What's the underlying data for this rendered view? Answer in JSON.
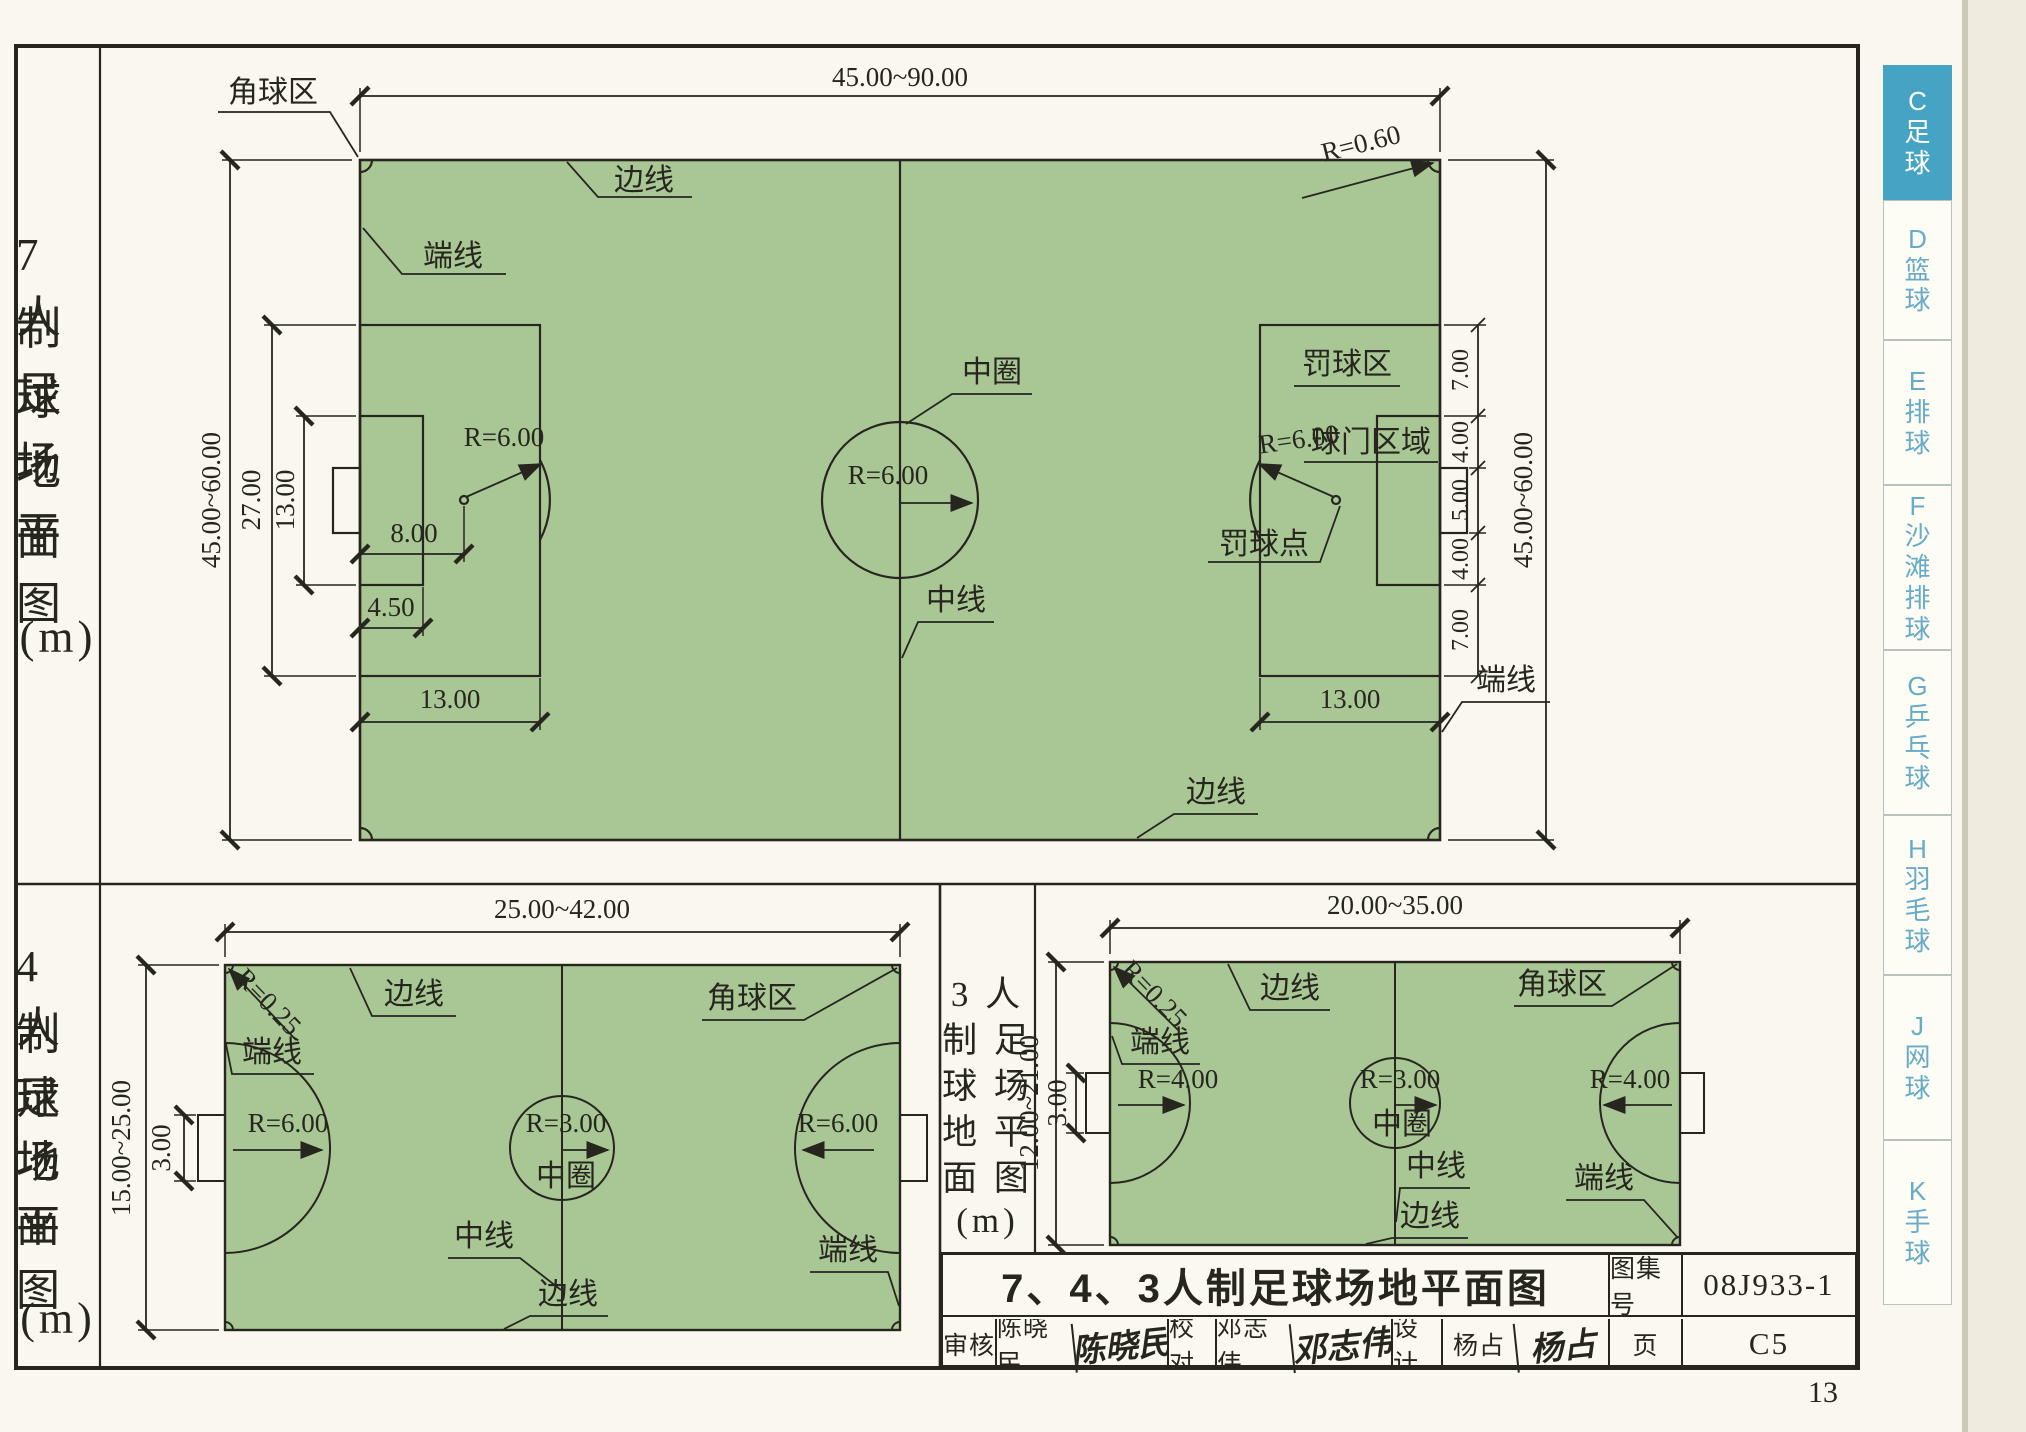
{
  "page": {
    "number": "13"
  },
  "colors": {
    "field_green": "#a9c795",
    "line": "#26261f",
    "tab_active_bg": "#45a3c4",
    "tab_text": "#66abc8"
  },
  "sidebar": {
    "tabs": [
      {
        "letter": "C",
        "name": "足球",
        "active": true
      },
      {
        "letter": "D",
        "name": "篮球",
        "active": false
      },
      {
        "letter": "E",
        "name": "排球",
        "active": false
      },
      {
        "letter": "F",
        "name": "沙滩排球",
        "active": false
      },
      {
        "letter": "G",
        "name": "乒乓球",
        "active": false
      },
      {
        "letter": "H",
        "name": "羽毛球",
        "active": false
      },
      {
        "letter": "J",
        "name": "网球",
        "active": false
      },
      {
        "letter": "K",
        "name": "手球",
        "active": false
      }
    ]
  },
  "title_block": {
    "title": "7、4、3人制足球场地平面图",
    "atlas_label": "图集号",
    "atlas_no": "08J933-1",
    "page_label": "页",
    "page_no": "C5",
    "review_label": "审核",
    "reviewer": "陈晓民",
    "reviewer_sig": "陈晓民",
    "check_label": "校对",
    "checker": "邓志伟",
    "checker_sig": "邓志伟",
    "design_label": "设计",
    "designer": "杨占",
    "designer_sig": "杨占"
  },
  "fields": {
    "f7": {
      "label_rows": [
        "7 人",
        "制 足",
        "球 场",
        "地 平",
        "面 图",
        "(m)"
      ],
      "dims": {
        "top": "45.00~90.00",
        "left_outer": "45.00~60.00",
        "left_27": "27.00",
        "left_13": "13.00",
        "left_8": "8.00",
        "left_45": "4.50",
        "left_13b": "13.00",
        "right_13b": "13.00",
        "right_chain": [
          "7.00",
          "4.00",
          "5.00",
          "4.00",
          "7.00"
        ],
        "right_outer": "45.00~60.00"
      },
      "labels": {
        "corner": "角球区",
        "corner_r": "R=0.60",
        "sideline_top": "边线",
        "endline_left": "端线",
        "center_circle": "中圈",
        "center_r": "R=6.00",
        "midline": "中线",
        "penalty_area": "罚球区",
        "goal_area": "球门区域",
        "penalty_r": "R=6.00",
        "penalty_r_left": "R=6.00",
        "penalty_spot": "罚球点",
        "endline_right": "端线",
        "sideline_bottom": "边线"
      }
    },
    "f4": {
      "label_rows": [
        "4 人",
        "制 足",
        "球 场",
        "地 平",
        "面 图",
        "(m)"
      ],
      "dims": {
        "top": "25.00~42.00",
        "left_outer": "15.00~25.00",
        "goal": "3.00"
      },
      "labels": {
        "corner_r": "R=0.25",
        "corner": "角球区",
        "sideline_top": "边线",
        "endline_left": "端线",
        "left_r": "R=6.00",
        "center_r": "R=3.00",
        "center_circle": "中圈",
        "right_r": "R=6.00",
        "midline": "中线",
        "endline_right": "端线",
        "sideline_bottom": "边线"
      }
    },
    "f3": {
      "label_rows": [
        "3 人",
        "制 足",
        "球 场",
        "地 平",
        "面 图",
        "(m)"
      ],
      "dims": {
        "top": "20.00~35.00",
        "left_outer": "12.00~21.00",
        "goal": "3.00"
      },
      "labels": {
        "corner_r": "R=0.25",
        "corner": "角球区",
        "sideline_top": "边线",
        "endline_left": "端线",
        "left_r": "R=4.00",
        "center_r": "R=3.00",
        "center_circle": "中圈",
        "right_r": "R=4.00",
        "midline": "中线",
        "endline_right": "端线",
        "sideline_bottom": "边线"
      }
    }
  }
}
